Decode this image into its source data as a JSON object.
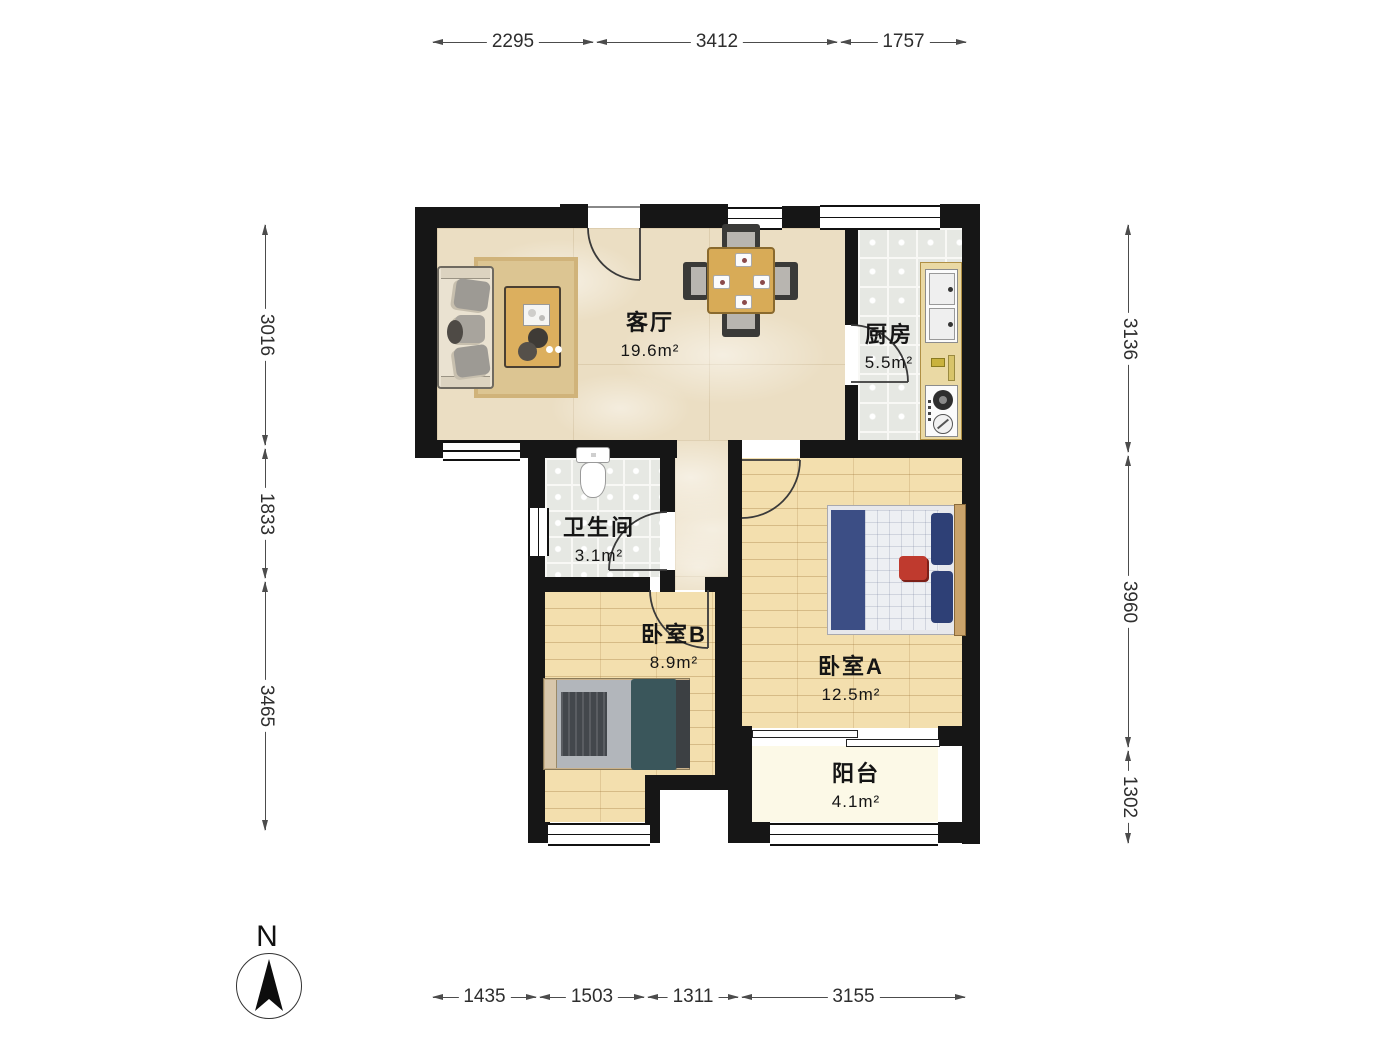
{
  "compass": {
    "label": "N"
  },
  "rooms": {
    "living": {
      "name": "客厅",
      "area": "19.6m²"
    },
    "kitchen": {
      "name": "厨房",
      "area": "5.5m²"
    },
    "bathroom": {
      "name": "卫生间",
      "area": "3.1m²"
    },
    "bedroom_b": {
      "name": "卧室B",
      "area": "8.9m²"
    },
    "bedroom_a": {
      "name": "卧室A",
      "area": "12.5m²"
    },
    "balcony": {
      "name": "阳台",
      "area": "4.1m²"
    }
  },
  "dimensions_mm": {
    "top": [
      "2295",
      "3412",
      "1757"
    ],
    "left": [
      "3016",
      "1833",
      "3465"
    ],
    "right": [
      "3136",
      "3960",
      "1302"
    ],
    "bottom": [
      "1435",
      "1503",
      "1311",
      "3155"
    ]
  },
  "colors": {
    "wall": "#161616",
    "marble_floor": "#ebdec3",
    "tile_floor": "#e6e8e3",
    "wood_floor": "#f3dfae",
    "balcony_floor": "#fcf9e7",
    "bed_a_navy": "#3c4e85",
    "bed_b_teal": "#3a565b",
    "table_wood": "#d8ab57"
  }
}
